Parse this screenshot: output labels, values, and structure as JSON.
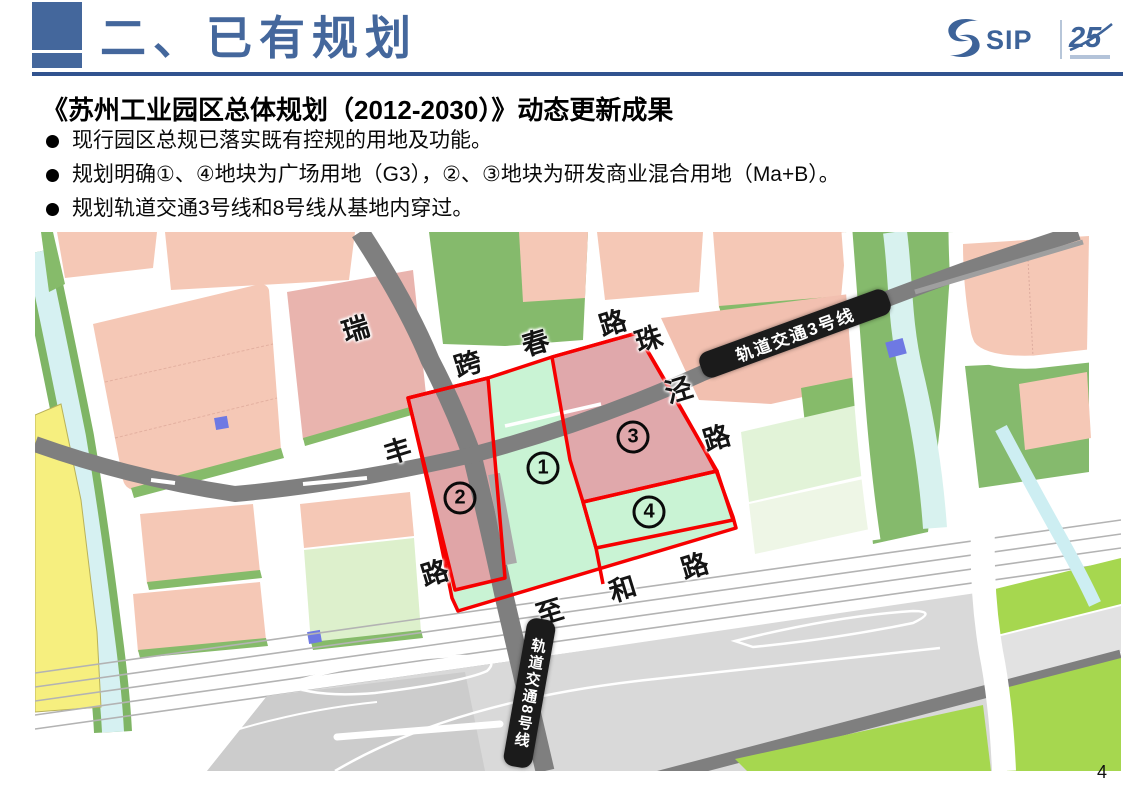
{
  "slide": {
    "title": "二、已有规划",
    "page_number": "4",
    "heading": "《苏州工业园区总体规划（2012-2030）》动态更新成果",
    "bullets": [
      "现行园区总规已落实既有控规的用地及功能。",
      "规划明确①、④地块为广场用地（G3），②、③地块为研发商业混合用地（Ma+B）。",
      "规划轨道交通3号线和8号线从基地内穿过。"
    ],
    "logo": {
      "sip": "SIP",
      "anniversary": "25"
    },
    "colors": {
      "accent_blue": "#44679C",
      "rule_blue": "#31538F",
      "logo_blue": "#3d6399",
      "highlight_red": "#F60000",
      "badge_black": "#1B1B1B",
      "plot_pink": "#E0A5A7",
      "plot_mint": "#C9F3D4",
      "block_pink": "#F5C8B6",
      "green_strip": "#86BB6A",
      "park_green": "#85BA6C",
      "bright_green": "#A6D74F",
      "water_cyan": "#D6F1F2",
      "land_yellow": "#F6EF7F",
      "road_gray": "#7F7F7F"
    }
  },
  "map": {
    "plots": [
      {
        "num": "1"
      },
      {
        "num": "2"
      },
      {
        "num": "3"
      },
      {
        "num": "4"
      }
    ],
    "rail_badges": [
      {
        "text": "轨道交通3号线"
      },
      {
        "text": "轨道交通8号线"
      }
    ],
    "road_labels": [
      {
        "text": "瑞"
      },
      {
        "text": "跨"
      },
      {
        "text": "春"
      },
      {
        "text": "路"
      },
      {
        "text": "珠"
      },
      {
        "text": "泾"
      },
      {
        "text": "路"
      },
      {
        "text": "丰"
      },
      {
        "text": "路"
      },
      {
        "text": "至"
      },
      {
        "text": "和"
      },
      {
        "text": "路"
      }
    ]
  }
}
